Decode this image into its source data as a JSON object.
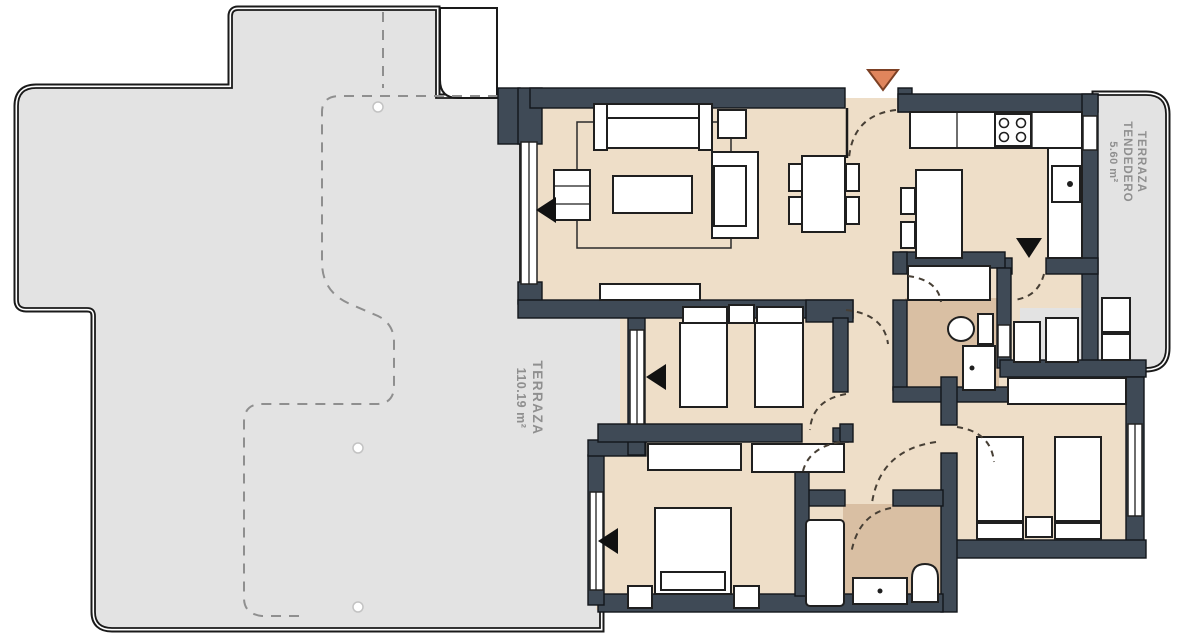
{
  "plan": {
    "terrace_label": {
      "name": "TERRAZA",
      "area": "110.19 m²"
    },
    "laundry_label": {
      "name": "TERRAZA",
      "type": "TENDEDERO",
      "area": "5.60 m²"
    }
  },
  "colors": {
    "wall": "#3f4a56",
    "floor": "#eedec8",
    "wet_floor": "#d9bfa3",
    "terrace": "#e3e3e3",
    "outline": "#1a1a1a",
    "entry_marker": "#e0855c",
    "label_text": "#8f8f8f"
  }
}
